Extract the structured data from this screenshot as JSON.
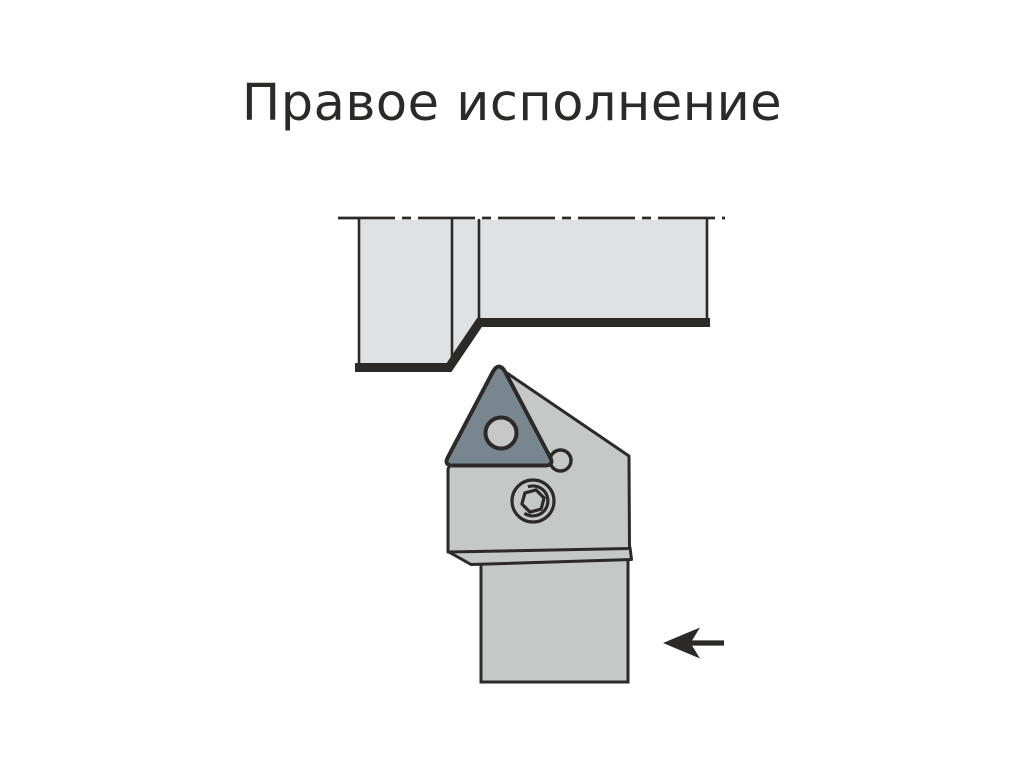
{
  "title": "Правое исполнение",
  "arrow": {
    "name": "feed-direction-arrow",
    "direction": "left"
  },
  "colors": {
    "background": "#ffffff",
    "title_text": "#2b2a29",
    "outline": "#2b2a29",
    "workpiece_fill": "#e0e1e2",
    "holder_fill": "#c6c7c7",
    "insert_fill": "#78878f"
  }
}
